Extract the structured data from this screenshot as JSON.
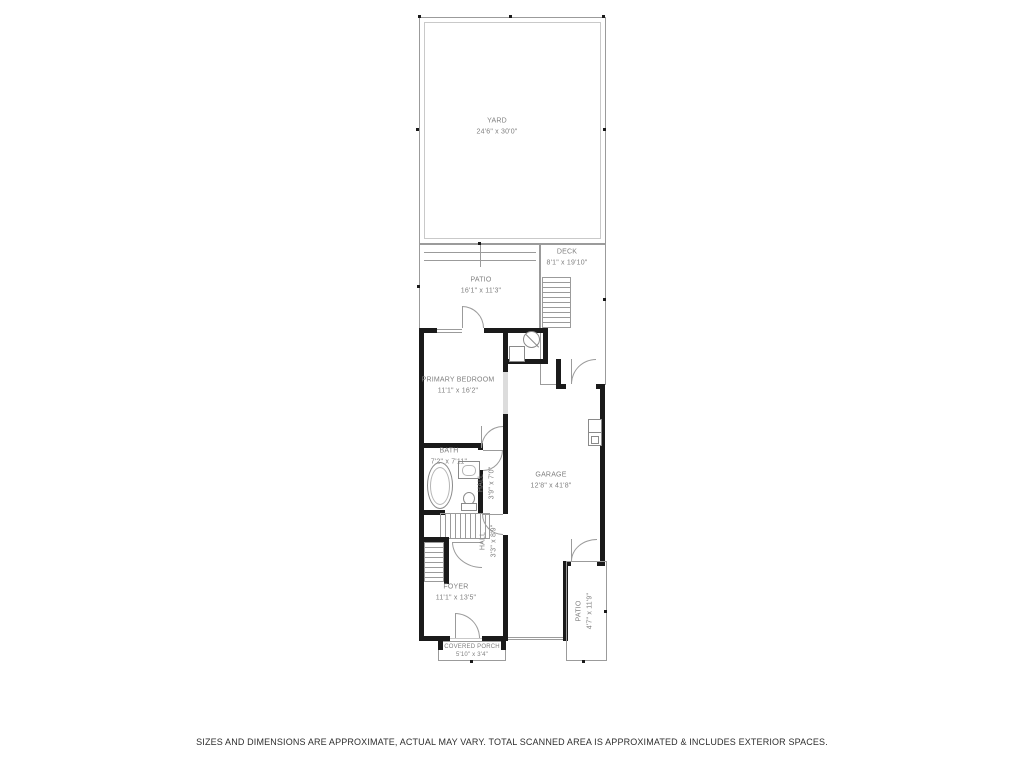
{
  "disclaimer": "SIZES AND DIMENSIONS ARE APPROXIMATE, ACTUAL MAY VARY. TOTAL SCANNED AREA IS APPROXIMATED & INCLUDES EXTERIOR SPACES.",
  "rooms": {
    "yard": {
      "name": "YARD",
      "dims": "24'6\" x 30'0\""
    },
    "patio_upper": {
      "name": "PATIO",
      "dims": "16'1\" x 11'3\""
    },
    "deck": {
      "name": "DECK",
      "dims": "8'1\" x 19'10\""
    },
    "primary_bedroom": {
      "name": "PRIMARY BEDROOM",
      "dims": "11'1\" x 16'2\""
    },
    "bath": {
      "name": "BATH",
      "dims": "7'2\" x 7'11\""
    },
    "hall_upper": {
      "name": "HALL",
      "dims": "3'9\" x 7'0\""
    },
    "garage": {
      "name": "GARAGE",
      "dims": "12'8\" x 41'8\""
    },
    "hall_lower": {
      "name": "HALL",
      "dims": "3'3\" x 8'9\""
    },
    "foyer": {
      "name": "FOYER",
      "dims": "11'1\" x 13'5\""
    },
    "covered_porch": {
      "name": "COVERED PORCH",
      "dims": "5'10\" x 3'4\""
    },
    "patio_lower": {
      "name": "PATIO",
      "dims": "4'7\" x 11'9\""
    }
  },
  "colors": {
    "wall": "#1a1a1a",
    "thin_line": "#9b9b9b",
    "label_text": "#7f7f7f",
    "background": "#ffffff"
  },
  "icons": [
    "bathtub-icon",
    "toilet-icon",
    "sink-icon",
    "water-heater-icon",
    "hvac-unit-icon",
    "electrical-panel-icon",
    "staircase-icon",
    "door-arc-icon",
    "window-icon",
    "measure-tick-icon"
  ]
}
